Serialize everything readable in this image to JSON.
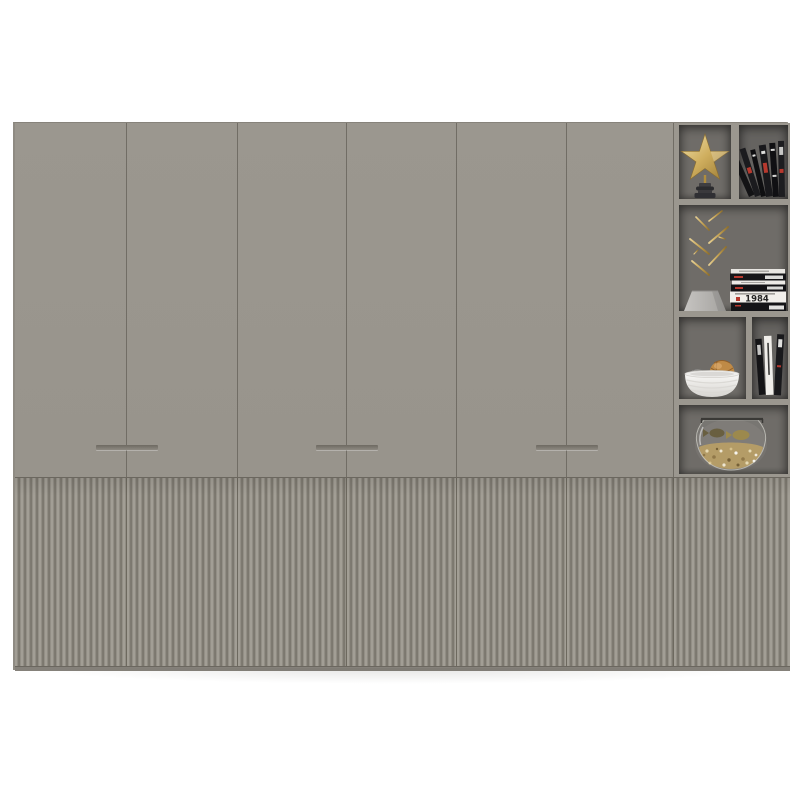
{
  "meta": {
    "description": "3D render of a wide gray wardrobe: six flat upper doors with recessed bar handles, vertical fluted lower door panels, and an open display shelf column on the right",
    "background_color": "#ffffff"
  },
  "palette": {
    "door_gray": "#9a968e",
    "seam_line": "#716d65",
    "flute_ridge": "#a29e95",
    "flute_groove": "#7c786f",
    "shelf_interior_gray": "#6f6c68",
    "base_strip": "#85817a",
    "accent_gold": "#c9a757",
    "book_black": "#17171a",
    "book_white": "#f0eeea",
    "accent_red": "#b7392e",
    "bowl_white": "#f6f5f3",
    "rattan_orange": "#bf8a46",
    "rattan_gray": "#8f8d8a",
    "vase_gray": "#bcbab7",
    "glass_rim": "#3a3936",
    "potpourri_tan": "#b2975c"
  },
  "cabinet": {
    "upper_doors": {
      "count": 6,
      "handle_count": 3,
      "handle_style": "recessed horizontal bar across shared door seams"
    },
    "lower_panels": {
      "count": 7,
      "texture": "vertical fluted reeding"
    },
    "shelf_column": {
      "rows": [
        {
          "row": 1,
          "items": [
            "gold star ornament on black turned pedestal",
            "leaning black books"
          ]
        },
        {
          "row": 2,
          "items": [
            "gold branch sculpture in gray trapezoid vase",
            "horizontal stack of black and white books"
          ]
        },
        {
          "row": 3,
          "items": [
            "white ribbed bowl with orange and gray rattan balls",
            "standing books"
          ]
        },
        {
          "row": 4,
          "items": [
            "glass fishbowl with dried botanicals and two fish"
          ]
        }
      ]
    }
  },
  "decor": {
    "book_spine_text": "1984"
  }
}
